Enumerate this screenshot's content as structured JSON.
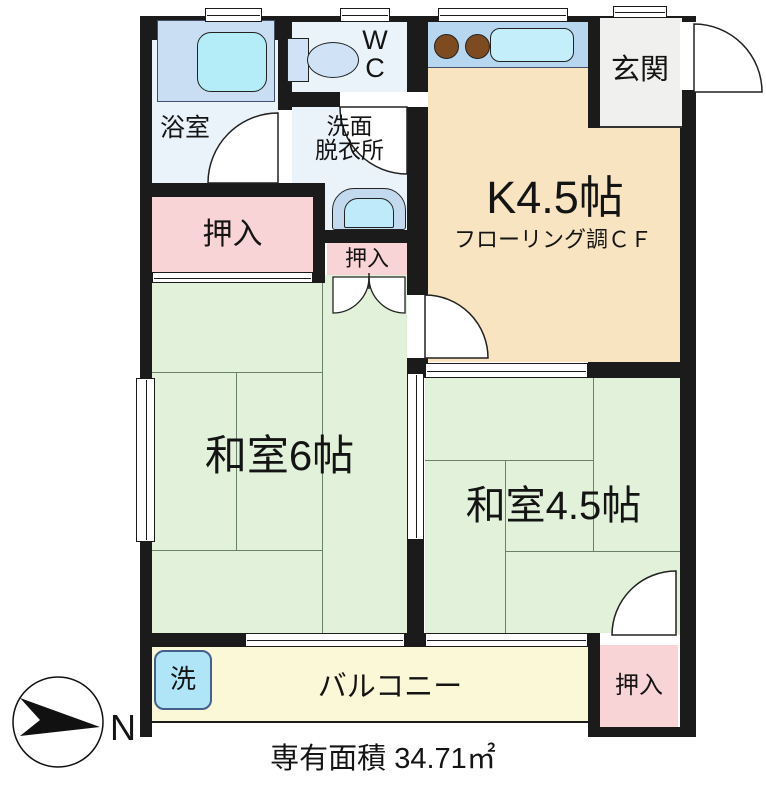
{
  "title": "間取り図",
  "plan": {
    "rooms": {
      "bath": "浴室",
      "wc": [
        "W",
        "C"
      ],
      "washroom": [
        "洗面",
        "脱衣所"
      ],
      "kitchen": "K4.5帖",
      "kitchen_note": "フローリング調ＣＦ",
      "entrance": "玄関",
      "closet_left": "押入",
      "closet_mid": "押入",
      "closet_bottom": "押入",
      "japanese_room_6": "和室6帖",
      "japanese_room_45": "和室4.5帖",
      "balcony": "バルコニー",
      "washer": "洗"
    },
    "footer": {
      "area": "専有面積 34.71㎡"
    },
    "compass": {
      "north": "N"
    },
    "colors": {
      "wall": "#1b1b1b",
      "tatami_room": "#e2f2da",
      "kitchen_floor": "#f8e4c0",
      "closet": "#f9d4d6",
      "balcony": "#fbf8d8",
      "wet_area": "#eaf2fa",
      "entrance": "#f0f0ee",
      "water_fixture": "#bfeafa",
      "counter_blue": "#b7d7f0",
      "burner_brown": "#7e4a1f"
    }
  }
}
